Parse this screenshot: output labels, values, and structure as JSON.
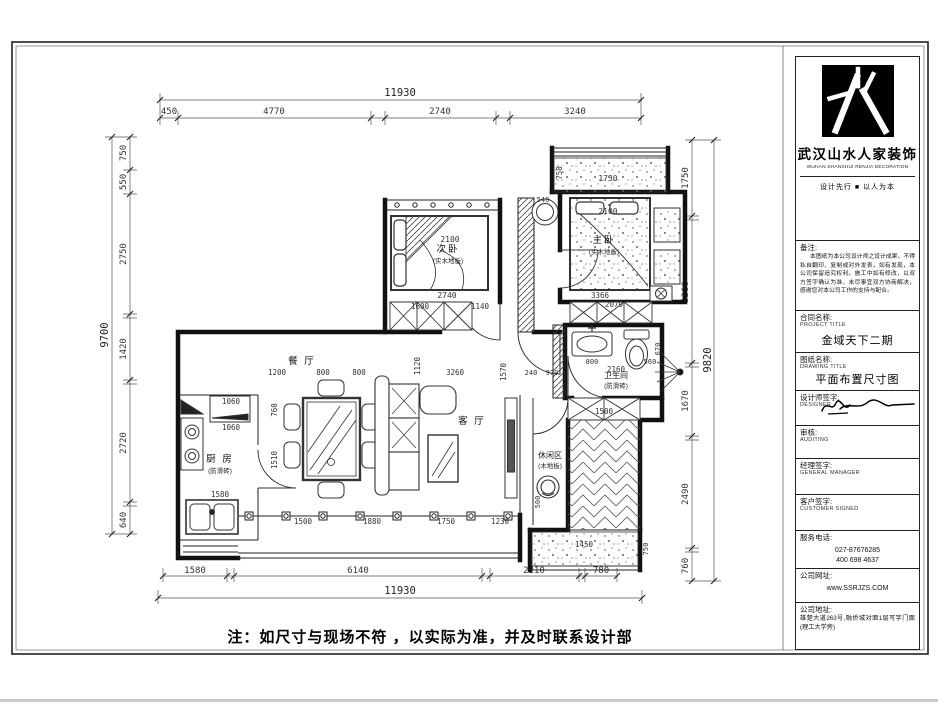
{
  "note": "注：如尺寸与现场不符 ，以实际为准，并及时联系设计部",
  "dims": {
    "top": {
      "overall": "11930",
      "segments": [
        "450",
        "4770",
        "2740",
        "3240"
      ]
    },
    "bottom": {
      "overall": "11930",
      "segments": [
        "1580",
        "6140",
        "2210",
        "780"
      ]
    },
    "left": {
      "overall": "9700",
      "segments": [
        "750",
        "550",
        "2750",
        "1420",
        "2720",
        "640"
      ]
    },
    "right": {
      "overall": "9820",
      "segments": [
        "1750",
        "3300",
        "1670",
        "2490",
        "760"
      ]
    }
  },
  "rooms": {
    "second_bedroom": {
      "name": "次卧",
      "note": "(实木地板)"
    },
    "master_bedroom": {
      "name": "主卧",
      "note": "(实木地板)"
    },
    "dining": {
      "name": "餐 厅"
    },
    "living": {
      "name": "客 厅"
    },
    "kitchen": {
      "name": "厨 房",
      "note": "(防滑砖)"
    },
    "bath": {
      "name": "卫生间",
      "note": "(防滑砖)"
    },
    "leisure": {
      "name": "休闲区",
      "note": "(木地板)"
    }
  },
  "plan": {
    "inner_dims": [
      "2100",
      "2740",
      "1600",
      "1140",
      "2100",
      "3366",
      "2070",
      "1730",
      "750",
      "540",
      "1200",
      "800",
      "800",
      "1120",
      "3260",
      "1570",
      "240",
      "970",
      "800",
      "2160",
      "560",
      "670",
      "1060",
      "1060",
      "1580",
      "1510",
      "760",
      "1500",
      "1450",
      "750",
      "500",
      "1500",
      "1880",
      "1750",
      "1230"
    ]
  },
  "title_block": {
    "logo_cn": "武汉山水人家装饰",
    "logo_en": "WUHAN SHANSHUI RENJIA DECORATION",
    "slogan": "设计先行 ■ 以人为本",
    "remark_label": "备注:",
    "remark_text": "本图纸为本公司设计师之设计成果，不得私自翻印、复制或对外发表，如有发现，本公司保留追究权利。施工中如有修改，以双方签字确认为准，未尽事宜双方协商解决，感谢您对本公司工作的支持与配合。",
    "project_label": "合同名称:",
    "project_label_en": "PROJECT TITLE",
    "project_value": "金域天下二期",
    "drawing_label": "图纸名称:",
    "drawing_label_en": "DRAWING TITLE",
    "drawing_value": "平面布置尺寸图",
    "designer_label": "设计师签字:",
    "designer_label_en": "DESIGNER",
    "audit_label": "审核:",
    "audit_label_en": "AUDITING",
    "manager_label": "经理签字:",
    "manager_label_en": "GENERAL MANAGER",
    "customer_label": "客户签字:",
    "customer_label_en": "CUSTOMER SIGNED",
    "phone_label": "服务电话:",
    "phone1": "027-87676285",
    "phone2": "400 698 4637",
    "web_label": "公司网址:",
    "web_value": "www.SSRJZS.COM",
    "addr_label": "公司地址:",
    "addr_value": "雄楚大道263号,融侨城对面1层写字门面(理工大学旁)"
  }
}
